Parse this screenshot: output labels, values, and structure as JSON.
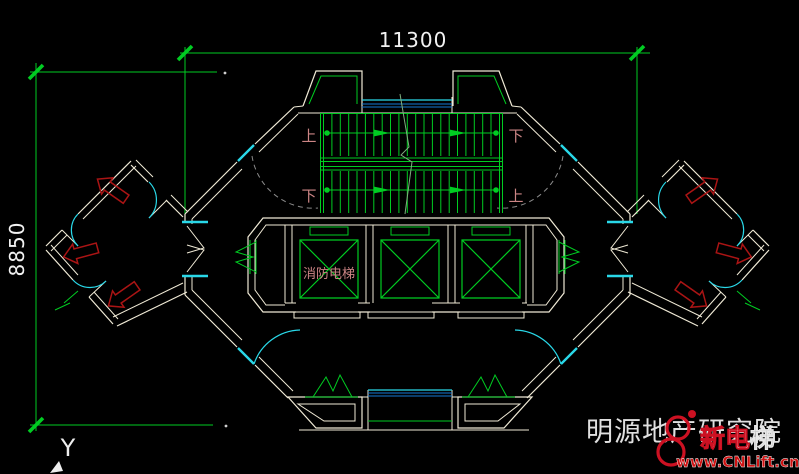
{
  "drawing": {
    "dimensions": {
      "top": "11300",
      "left": "8850"
    },
    "stair": {
      "label_tl": "上",
      "label_tr": "下",
      "label_bl": "下",
      "label_br": "上"
    },
    "elevator": {
      "fire_elevator_label": "消防电梯"
    },
    "axis": {
      "y_label": "Y"
    },
    "colors": {
      "background": "#000000",
      "wall": "#f0ead6",
      "green": "#00cc22",
      "window_cyan": "#29d8e8",
      "window_blue": "#1379d4",
      "exit_arrow_red": "#aa1414",
      "annotation_rose": "#cc8585",
      "dimension_text": "#f2f2f2",
      "watermark_gray": "#e0e0e0",
      "logo_red": "#cc1122"
    }
  },
  "watermark": {
    "text": "明源地产研究院"
  },
  "logo": {
    "brand_main": "新电",
    "brand_suffix": "梯",
    "url": "www.CNLift.cn"
  }
}
